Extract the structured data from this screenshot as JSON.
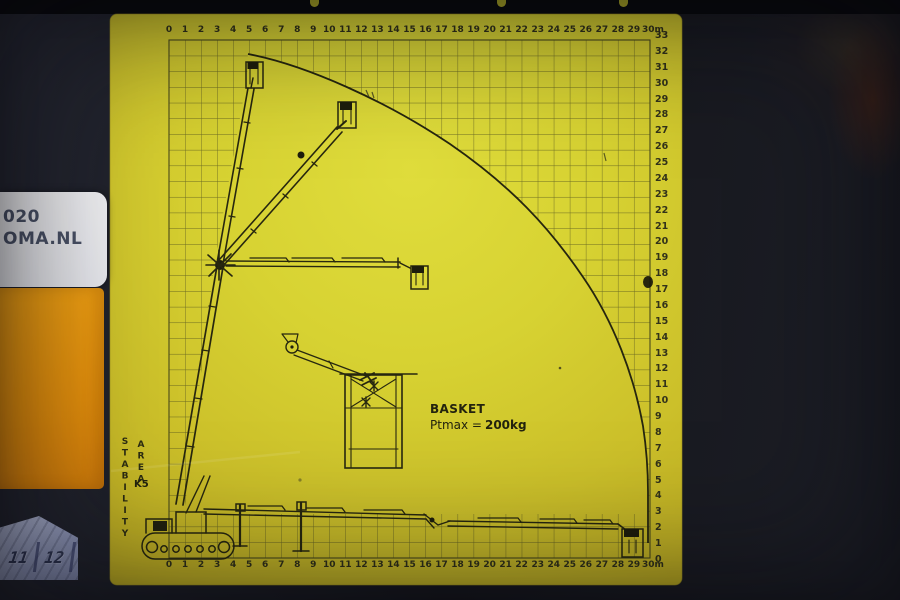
{
  "labels": {
    "axis_top": [
      "0",
      "1",
      "2",
      "3",
      "4",
      "5",
      "6",
      "7",
      "8",
      "9",
      "10",
      "11",
      "12",
      "13",
      "14",
      "15",
      "16",
      "17",
      "18",
      "19",
      "20",
      "21",
      "22",
      "23",
      "24",
      "25",
      "26",
      "27",
      "28",
      "29",
      "30m"
    ],
    "axis_bottom": [
      "0",
      "1",
      "2",
      "3",
      "4",
      "5",
      "6",
      "7",
      "8",
      "9",
      "10",
      "11",
      "12",
      "13",
      "14",
      "15",
      "16",
      "17",
      "18",
      "19",
      "20",
      "21",
      "22",
      "23",
      "24",
      "25",
      "26",
      "27",
      "28",
      "29",
      "30m"
    ],
    "axis_right": [
      "33",
      "32",
      "31",
      "30",
      "29",
      "28",
      "27",
      "26",
      "25",
      "24",
      "23",
      "22",
      "21",
      "20",
      "19",
      "18",
      "17",
      "16",
      "15",
      "14",
      "13",
      "12",
      "11",
      "10",
      "9",
      "8",
      "7",
      "6",
      "5",
      "4",
      "3",
      "2",
      "1",
      "0"
    ]
  },
  "annotations": {
    "basket_title": "BASKET",
    "ptmax_label": "Ptmax =",
    "ptmax_value": "200kg",
    "stability_word": "STABILITY",
    "area_word": "AREA",
    "k_class": "K5"
  },
  "side_labels": {
    "white_label_line1": "020",
    "white_label_line2": "OMA.NL"
  },
  "embossed": {
    "left": "11",
    "right": "12"
  },
  "diagram": {
    "unit": "m",
    "x_axis_range_m": [
      0,
      30
    ],
    "y_axis_range_m": [
      0,
      33
    ],
    "envelope_curve_m": [
      [
        4.9,
        32
      ],
      [
        10,
        30
      ],
      [
        14.5,
        28
      ],
      [
        18.5,
        25
      ],
      [
        22,
        21
      ],
      [
        25,
        16.5
      ],
      [
        27.5,
        12
      ],
      [
        29,
        8
      ],
      [
        29.9,
        3
      ],
      [
        29.9,
        0.8
      ]
    ]
  },
  "colors": {
    "plate_yellow_light": "#dedb3a",
    "plate_yellow_dark": "#bfae22",
    "diagram_ink": "#27270f",
    "grid_line": "#50501e",
    "orange_sticker": "#ef9a10",
    "white_sticker": "#f2f3f6",
    "sticker_text": "#4b5368",
    "embossed_panel": "#9ba3c4",
    "embossed_text": "#2e3552",
    "photo_background": "#1d1f27"
  }
}
